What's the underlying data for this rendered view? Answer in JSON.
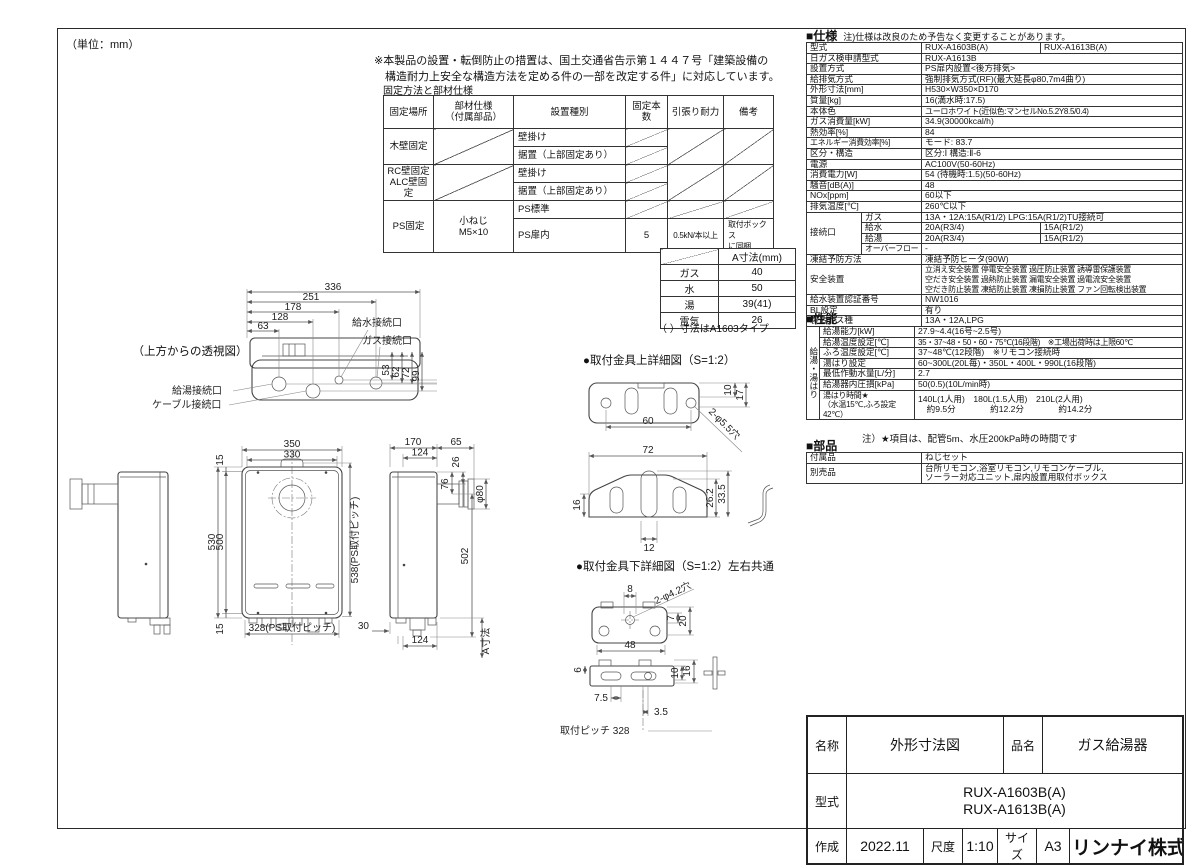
{
  "sheet": {
    "unit_note": "（単位：mm）",
    "page_mark": "100"
  },
  "note": {
    "line1": "※本製品の設置・転倒防止の措置は、国土交通省告示第１４４７号「建築設備の",
    "line2": "　構造耐力上安全な構造方法を定める件の一部を改定する件」に対応しています。"
  },
  "fixing": {
    "title": "固定方法と部材仕様",
    "rows": [
      [
        {
          "t": "固定場所",
          "cls": "hd"
        },
        {
          "t": "部材仕様\n（付属部品）",
          "cls": "hd"
        },
        {
          "t": "設置種別",
          "cls": "hd"
        },
        {
          "t": "固定本数",
          "cls": "hd"
        },
        {
          "t": "引張り耐力",
          "cls": "hd"
        },
        {
          "t": "備考",
          "cls": "hd"
        }
      ],
      [
        {
          "t": "木壁固定",
          "rs": 2,
          "cls": "ct"
        },
        {
          "t": "",
          "rs": 2,
          "cls": "dg"
        },
        {
          "t": "壁掛け",
          "cls": "lf"
        },
        {
          "t": "",
          "cls": "dg"
        },
        {
          "t": "",
          "rs": 2,
          "cls": "dg"
        },
        {
          "t": "",
          "rs": 2,
          "cls": "dg"
        }
      ],
      [
        {
          "t": "据置（上部固定あり）",
          "cls": "lf"
        },
        {
          "t": "",
          "cls": "dg"
        }
      ],
      [
        {
          "t": "RC壁固定\nALC壁固定",
          "rs": 2,
          "cls": "ct"
        },
        {
          "t": "",
          "rs": 2,
          "cls": "dg"
        },
        {
          "t": "壁掛け",
          "cls": "lf"
        },
        {
          "t": "",
          "cls": "dg"
        },
        {
          "t": "",
          "rs": 2,
          "cls": "dg"
        },
        {
          "t": "",
          "rs": 2,
          "cls": "dg"
        }
      ],
      [
        {
          "t": "据置（上部固定あり）",
          "cls": "lf"
        },
        {
          "t": "",
          "cls": "dg"
        }
      ],
      [
        {
          "t": "PS固定",
          "rs": 2,
          "cls": "ct"
        },
        {
          "t": "小ねじ\nM5×10",
          "rs": 2,
          "cls": "ct"
        },
        {
          "t": "PS標準",
          "cls": "lf"
        },
        {
          "t": "",
          "cls": "dg"
        },
        {
          "t": "",
          "cls": "dg"
        },
        {
          "t": "",
          "cls": "dg"
        }
      ],
      [
        {
          "t": "PS扉内",
          "cls": "lf"
        },
        {
          "t": "5",
          "cls": "ct"
        },
        {
          "t": "0.5kN/本以上",
          "cls": "ct sm"
        },
        {
          "t": "取付ボックス\nに同梱",
          "cls": "lf sm"
        }
      ]
    ]
  },
  "a_table": {
    "header": "A寸法(mm)",
    "rows": [
      [
        {
          "t": "",
          "cls": "dg"
        },
        {
          "t": "A寸法(mm)"
        }
      ],
      [
        {
          "t": "ガス"
        },
        {
          "t": "40"
        }
      ],
      [
        {
          "t": "水"
        },
        {
          "t": "50"
        }
      ],
      [
        {
          "t": "湯"
        },
        {
          "t": "39(41)"
        }
      ],
      [
        {
          "t": "電気"
        },
        {
          "t": "26"
        }
      ]
    ],
    "note": "（ ）寸法はA1603タイプ"
  },
  "drawing": {
    "top": {
      "caption": "（上方からの透視図）",
      "d336": "336",
      "d251": "251",
      "d178": "178",
      "d128": "128",
      "d63": "63",
      "d53": "53",
      "d62": "62",
      "d72": "72",
      "d99": "99",
      "lbl_kyusui": "給水接続口",
      "lbl_gas": "ガス接続口",
      "lbl_kyuto": "給湯接続口",
      "lbl_cable": "ケーブル接続口"
    },
    "front": {
      "d350": "350",
      "d330": "330",
      "d15t": "15",
      "d530": "530",
      "d500": "500",
      "d15b": "15",
      "d538": "538(PS取付ピッチ)",
      "d328": "328(PS取付ピッチ)"
    },
    "side": {
      "d170": "170",
      "d65": "65",
      "d124t": "124",
      "d26": "26",
      "d80": "φ80",
      "d76": "76",
      "d502": "502",
      "d30": "30",
      "d124b": "124",
      "dA": "A寸法"
    },
    "bkt_top": {
      "caption": "●取付金具上詳細図（S=1:2）",
      "d60": "60",
      "d10": "10",
      "d17": "17",
      "holes": "2-φ5.5穴",
      "d72": "72",
      "d16": "16",
      "d262": "26.2",
      "d335": "33.5",
      "d12": "12"
    },
    "bkt_bot": {
      "caption": "●取付金具下詳細図（S=1:2）",
      "caption2": "左右共通",
      "d8": "8",
      "holes": "2-φ4.2穴",
      "d7": "7",
      "d20": "20",
      "d48": "48",
      "d6": "6",
      "d10": "10",
      "d16": "16",
      "d75": "7.5",
      "d35": "3.5",
      "pitch": "取付ピッチ 328"
    }
  },
  "spec": {
    "title": "■仕様",
    "note": "注)仕様は改良のため予告なく変更することがあります。",
    "rows": [
      [
        {
          "t": "型式",
          "cs": 2,
          "cls": "lb"
        },
        {
          "t": "RUX-A1603B(A)",
          "cls": "vl"
        },
        {
          "t": "RUX-A1613B(A)",
          "cls": "vl"
        }
      ],
      [
        {
          "t": "日ガス検申請型式",
          "cs": 2,
          "cls": "lb"
        },
        {
          "t": "RUX-A1613B",
          "cs": 2,
          "cls": "vl"
        }
      ],
      [
        {
          "t": "設置方式",
          "cs": 2,
          "cls": "lb"
        },
        {
          "t": "PS扉内設置<後方排気>",
          "cs": 2,
          "cls": "vl"
        }
      ],
      [
        {
          "t": "給排気方式",
          "cs": 2,
          "cls": "lb"
        },
        {
          "t": "強制排気方式(RF)(最大延長φ80,7m4曲り)",
          "cs": 2,
          "cls": "vl"
        }
      ],
      [
        {
          "t": "外形寸法[mm]",
          "cs": 2,
          "cls": "lb"
        },
        {
          "t": "H530×W350×D170",
          "cs": 2,
          "cls": "vl"
        }
      ],
      [
        {
          "t": "質量[kg]",
          "cs": 2,
          "cls": "lb"
        },
        {
          "t": "16(満水時:17.5)",
          "cs": 2,
          "cls": "vl"
        }
      ],
      [
        {
          "t": "本体色",
          "cs": 2,
          "cls": "lb"
        },
        {
          "t": "ユーロホワイト(近似色:マンセルNo.5.2Y8.5/0.4)",
          "cs": 2,
          "cls": "vl sm"
        }
      ],
      [
        {
          "t": "ガス消費量[kW]",
          "cs": 2,
          "cls": "lb"
        },
        {
          "t": "34.9(30000kcal/h)",
          "cs": 2,
          "cls": "vl"
        }
      ],
      [
        {
          "t": "熱効率[%]",
          "cs": 2,
          "cls": "lb"
        },
        {
          "t": "84",
          "cs": 2,
          "cls": "vl"
        }
      ],
      [
        {
          "t": "エネルギー消費効率[%]",
          "cs": 2,
          "cls": "lb sm"
        },
        {
          "t": "モード: 83.7",
          "cs": 2,
          "cls": "vl"
        }
      ],
      [
        {
          "t": "区分・構造",
          "cs": 2,
          "cls": "lb"
        },
        {
          "t": "区分:Ⅰ 構造:Ⅱ-6",
          "cs": 2,
          "cls": "vl"
        }
      ],
      [
        {
          "t": "電源",
          "cs": 2,
          "cls": "lb"
        },
        {
          "t": "AC100V(50-60Hz)",
          "cs": 2,
          "cls": "vl"
        }
      ],
      [
        {
          "t": "消費電力[W]",
          "cs": 2,
          "cls": "lb"
        },
        {
          "t": "54 (待機時:1.5)(50-60Hz)",
          "cs": 2,
          "cls": "vl"
        }
      ],
      [
        {
          "t": "騒音[dB(A)]",
          "cs": 2,
          "cls": "lb"
        },
        {
          "t": "48",
          "cs": 2,
          "cls": "vl"
        }
      ],
      [
        {
          "t": "NOx[ppm]",
          "cs": 2,
          "cls": "lb"
        },
        {
          "t": "60以下",
          "cs": 2,
          "cls": "vl"
        }
      ],
      [
        {
          "t": "排気温度[℃]",
          "cs": 2,
          "cls": "lb"
        },
        {
          "t": "260℃以下",
          "cs": 2,
          "cls": "vl"
        }
      ],
      [
        {
          "t": "接続口",
          "rs": 4,
          "cls": "lb"
        },
        {
          "t": "ガス",
          "cls": "sb"
        },
        {
          "t": "13A・12A:15A(R1/2) LPG:15A(R1/2)TU接続可",
          "cs": 2,
          "cls": "vl"
        }
      ],
      [
        {
          "t": "給水",
          "cls": "sb"
        },
        {
          "t": "20A(R3/4)",
          "cls": "vl"
        },
        {
          "t": "15A(R1/2)",
          "cls": "vl"
        }
      ],
      [
        {
          "t": "給湯",
          "cls": "sb"
        },
        {
          "t": "20A(R3/4)",
          "cls": "vl"
        },
        {
          "t": "15A(R1/2)",
          "cls": "vl"
        }
      ],
      [
        {
          "t": "オーバーフロー",
          "cls": "sb sm"
        },
        {
          "t": "-",
          "cs": 2,
          "cls": "vl"
        }
      ],
      [
        {
          "t": "凍結予防方法",
          "cs": 2,
          "cls": "lb"
        },
        {
          "t": "凍結予防ヒータ(90W)",
          "cs": 2,
          "cls": "vl"
        }
      ],
      [
        {
          "t": "安全装置",
          "cs": 2,
          "cls": "lb"
        },
        {
          "t": "立消え安全装置 停電安全装置 過圧防止装置 誘導雷保護装置\n空だき安全装置 過熱防止装置 漏電安全装置 過電流安全装置\n空だき防止装置 凍結防止装置 凍損防止装置 ファン回転検出装置",
          "cs": 2,
          "cls": "vl sm"
        }
      ],
      [
        {
          "t": "給水装置認証番号",
          "cs": 2,
          "cls": "lb"
        },
        {
          "t": "NW1016",
          "cs": 2,
          "cls": "vl"
        }
      ],
      [
        {
          "t": "BL設定",
          "cs": 2,
          "cls": "lb"
        },
        {
          "t": "有り",
          "cs": 2,
          "cls": "vl"
        }
      ],
      [
        {
          "t": "製造ガス種",
          "cs": 2,
          "cls": "lb"
        },
        {
          "t": "13A・12A,LPG",
          "cs": 2,
          "cls": "vl"
        }
      ]
    ]
  },
  "perf": {
    "title": "■性能",
    "note": "注）★項目は、配管5m、水圧200kPa時の時間です",
    "rows": [
      [
        {
          "t": "給湯・湯はり",
          "rs": 7,
          "cls": "vt"
        },
        {
          "t": "給湯能力[kW]",
          "cls": "lb"
        },
        {
          "t": "27.9~4.4(16号~2.5号)",
          "cls": "vl"
        }
      ],
      [
        {
          "t": "給湯温度設定[℃]",
          "cls": "lb"
        },
        {
          "t": "35・37~48・50・60・75℃(16段階)　※工場出荷時は上限60℃",
          "cls": "vl sm"
        }
      ],
      [
        {
          "t": "ふろ温度設定[℃]",
          "cls": "lb"
        },
        {
          "t": "37~48℃(12段階)　※リモコン接続時",
          "cls": "vl"
        }
      ],
      [
        {
          "t": "湯はり設定",
          "cls": "lb"
        },
        {
          "t": "60~300L(20L毎)・350L・400L・990L(16段階)",
          "cls": "vl"
        }
      ],
      [
        {
          "t": "最低作動水量[L/分]",
          "cls": "lb"
        },
        {
          "t": "2.7",
          "cls": "vl"
        }
      ],
      [
        {
          "t": "給湯器内圧損[kPa]",
          "cls": "lb"
        },
        {
          "t": "50(0.5)(10L/min時)",
          "cls": "vl"
        }
      ],
      [
        {
          "t": "湯はり時間★\n（水温15℃,ふろ設定42℃）",
          "cls": "lb sm"
        },
        {
          "t": "140L(1人用)　180L(1.5人用)　210L(2人用)\n　約9.5分　　　　約12.2分　　　　約14.2分",
          "cls": "vl"
        }
      ]
    ]
  },
  "parts": {
    "title": "■部品",
    "rows": [
      [
        {
          "t": "付属品",
          "cls": "lb"
        },
        {
          "t": "ねじセット",
          "cls": "vl"
        }
      ],
      [
        {
          "t": "別売品",
          "cls": "lb"
        },
        {
          "t": "台所リモコン,浴室リモコン,リモコンケーブル,\nソーラー対応ユニット,扉内設置用取付ボックス",
          "cls": "vl"
        }
      ]
    ]
  },
  "titleblock": {
    "name_label": "名称",
    "name": "外形寸法図",
    "product_label": "品名",
    "product": "ガス給湯器",
    "model_label": "型式",
    "model1": "RUX-A1603B(A)",
    "model2": "RUX-A1613B(A)",
    "created_label": "作成",
    "created": "2022.11",
    "scale_label": "尺度",
    "scale": "1:10",
    "size_label": "サイズ",
    "size": "A3",
    "company": "リンナイ株式会社"
  }
}
